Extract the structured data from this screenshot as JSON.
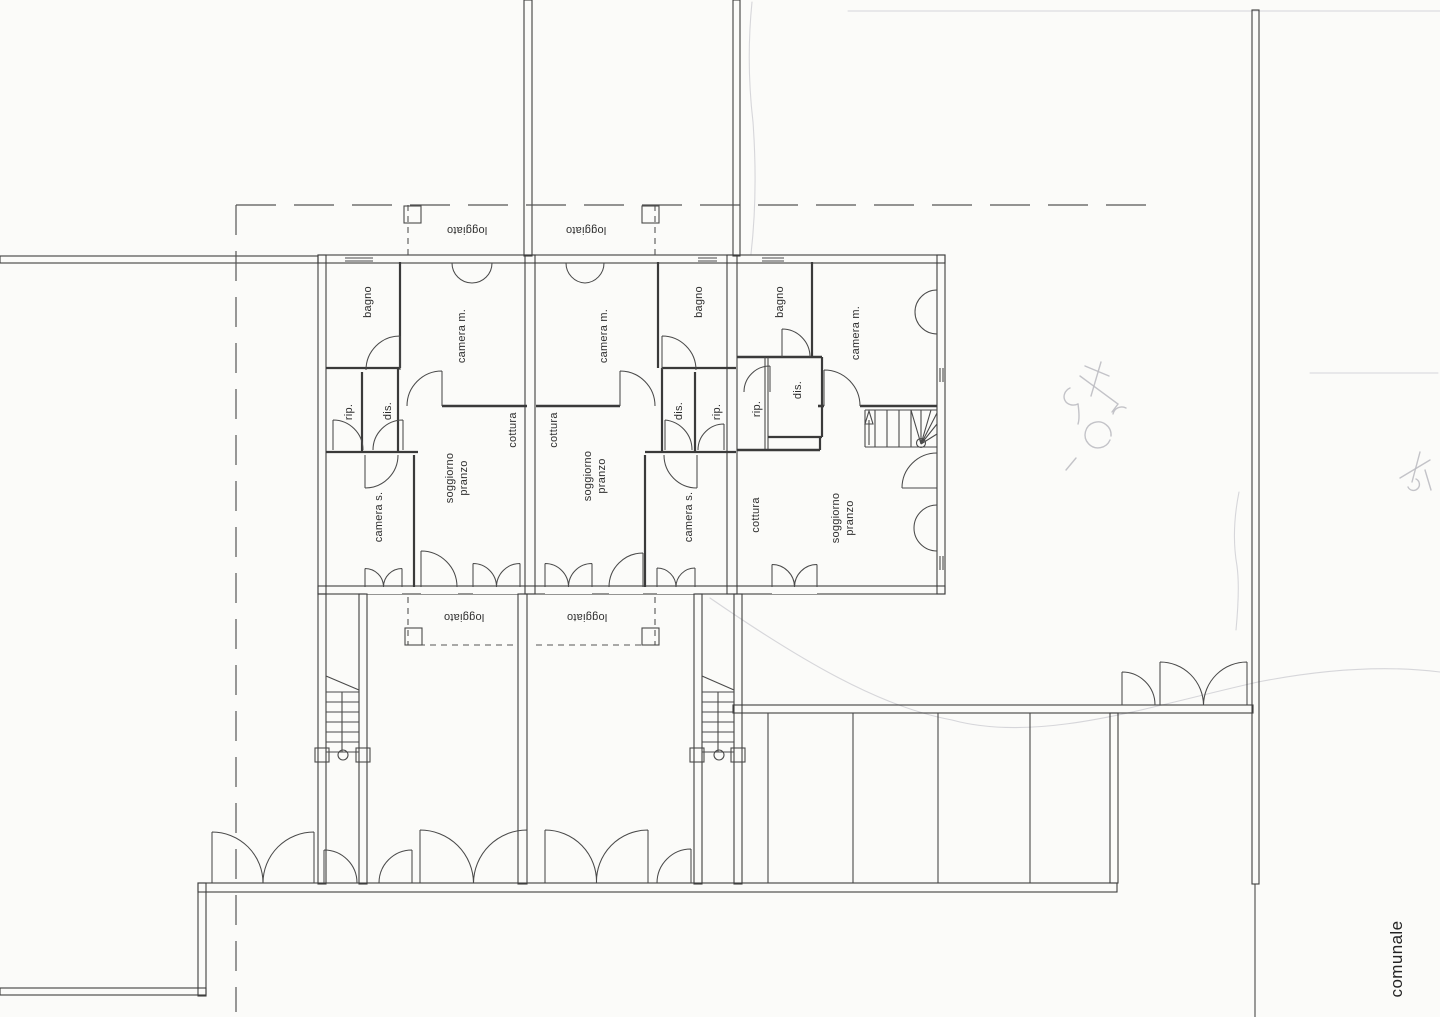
{
  "document": {
    "kind": "scanned architectural floor plan",
    "language": "Italian"
  },
  "colors": {
    "paper": "#fbfbf9",
    "ink": "#3a3a3a",
    "pencil": "#bdbdc2"
  },
  "plan": {
    "room_labels": {
      "loggiato": "loggiato",
      "bagno": "bagno",
      "camera_m": "camera m.",
      "camera_s": "camera s.",
      "rip": "rip.",
      "dis": "dis.",
      "cottura": "cottura",
      "soggiorno": "soggiorno",
      "pranzo": "pranzo"
    },
    "site_label": "comunale",
    "units": [
      {
        "id": "unit-left",
        "rooms": [
          "bagno",
          "camera m.",
          "rip.",
          "dis.",
          "camera s.",
          "cottura",
          "soggiorno pranzo"
        ],
        "loggiato_count": 2
      },
      {
        "id": "unit-middle",
        "rooms": [
          "bagno",
          "camera m.",
          "rip.",
          "dis.",
          "camera s.",
          "cottura",
          "soggiorno pranzo"
        ],
        "loggiato_count": 2
      },
      {
        "id": "unit-right",
        "rooms": [
          "bagno",
          "camera m.",
          "rip.",
          "dis.",
          "cottura",
          "soggiorno pranzo"
        ],
        "loggiato_count": 0
      }
    ]
  }
}
